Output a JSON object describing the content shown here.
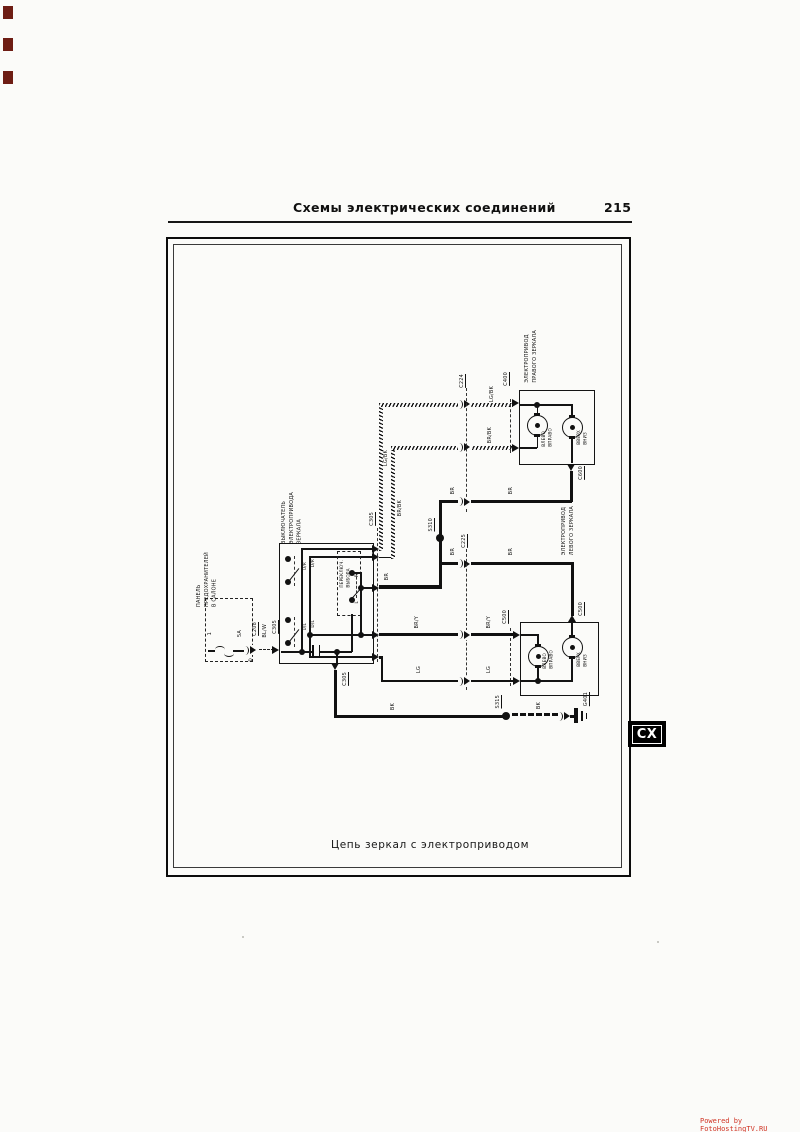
{
  "page": {
    "header_title": "Схемы  электрических  соединений",
    "page_number": "215",
    "caption": "Цепь  зеркал  с  электроприводом",
    "side_tab": "CX",
    "watermark": "Powered by FotoHostingTV.RU"
  },
  "components": {
    "fuse_panel": {
      "name": "ПАНЕЛЬ\nПРЕДОХРАНИТЕЛЕЙ\nВ САЛОНЕ",
      "fuse_number": "1",
      "fuse_rating": "5A",
      "pin": "D"
    },
    "mirror_switch": {
      "name": "ВЫКЛЮЧАТЕЛЬ\nЭЛЕКТРОПРИВОДА\nЗЕРКАЛА",
      "selector": "ПЕРЕКЛЮЧ.\nВЫБОРА",
      "pos_up_right": "U/R",
      "pos_down_right": "D/R",
      "pos_up_left": "U/L",
      "pos_down_left": "D/L",
      "pos_right": "R",
      "pos_left": "L"
    },
    "right_mirror": {
      "name": "ЭЛЕКТРОПРИВОД\nПРАВОГО ЗЕРКАЛА",
      "motor_lr": "ВЛЕВО\nВПРАВО",
      "motor_ud": "ВВЕРХ\nВНИЗ"
    },
    "left_mirror": {
      "name": "ЭЛЕКТРОПРИВОД\nЛЕВОГО ЗЕРКАЛА",
      "motor_lr": "ВЛЕВО\nВПРАВО",
      "motor_ud": "ВВЕРХ\nВНИЗ"
    }
  },
  "connectors": {
    "c208": "C208",
    "c305": "C305",
    "c224": "C224",
    "c225": "C225",
    "c400": "C400",
    "c500": "C500",
    "c600": "C600",
    "s310": "S310",
    "s315": "S315",
    "g401": "G401"
  },
  "wires": {
    "bl_w": "BL/W",
    "lg_bk": "LG/BK",
    "br_bk": "BR/BK",
    "br": "BR",
    "br_y": "BR/Y",
    "lg": "LG",
    "bk": "BK"
  }
}
